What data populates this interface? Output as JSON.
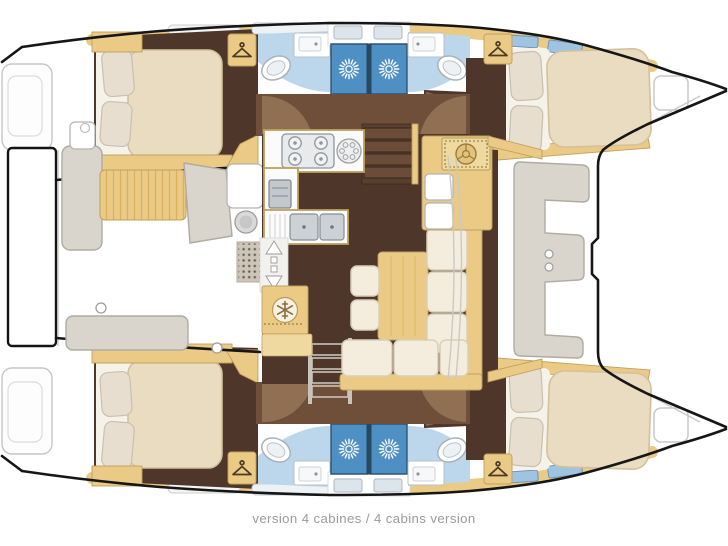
{
  "caption": {
    "text": "version 4 cabines / 4 cabins version"
  },
  "palette": {
    "background": "#ffffff",
    "hull_outline": "#161616",
    "deck_line": "#c9c9c9",
    "wood_trim": "#eaca84",
    "wood_light": "#f0d9a0",
    "wood_edge": "#bfa05e",
    "floor_dark": "#4e362b",
    "floor_mid": "#6f4f3a",
    "door_swing": "#9b7a5c",
    "bathroom_floor": "#bcd7ec",
    "shower_blue": "#4e8fc4",
    "shower_frame": "#2e5574",
    "mattress": "#e9dcc0",
    "mattress_edge": "#d2c19c",
    "pillow": "#e7ded0",
    "sheet": "#f5f2ea",
    "cushion": "#f4eddd",
    "cushion_edge": "#d9cfba",
    "counter": "#fbfbfb",
    "bench_gray": "#d9d4cc",
    "caption_text": "#9b9b9b"
  },
  "legend_icons": {
    "hanger": "wardrobe-hanging-locker",
    "sunburst": "shower-head",
    "snowflake": "fridge-freezer",
    "double-arrow": "sliding-entry-door",
    "burners": "galley-stove",
    "helm-dial": "nav-instrument"
  }
}
